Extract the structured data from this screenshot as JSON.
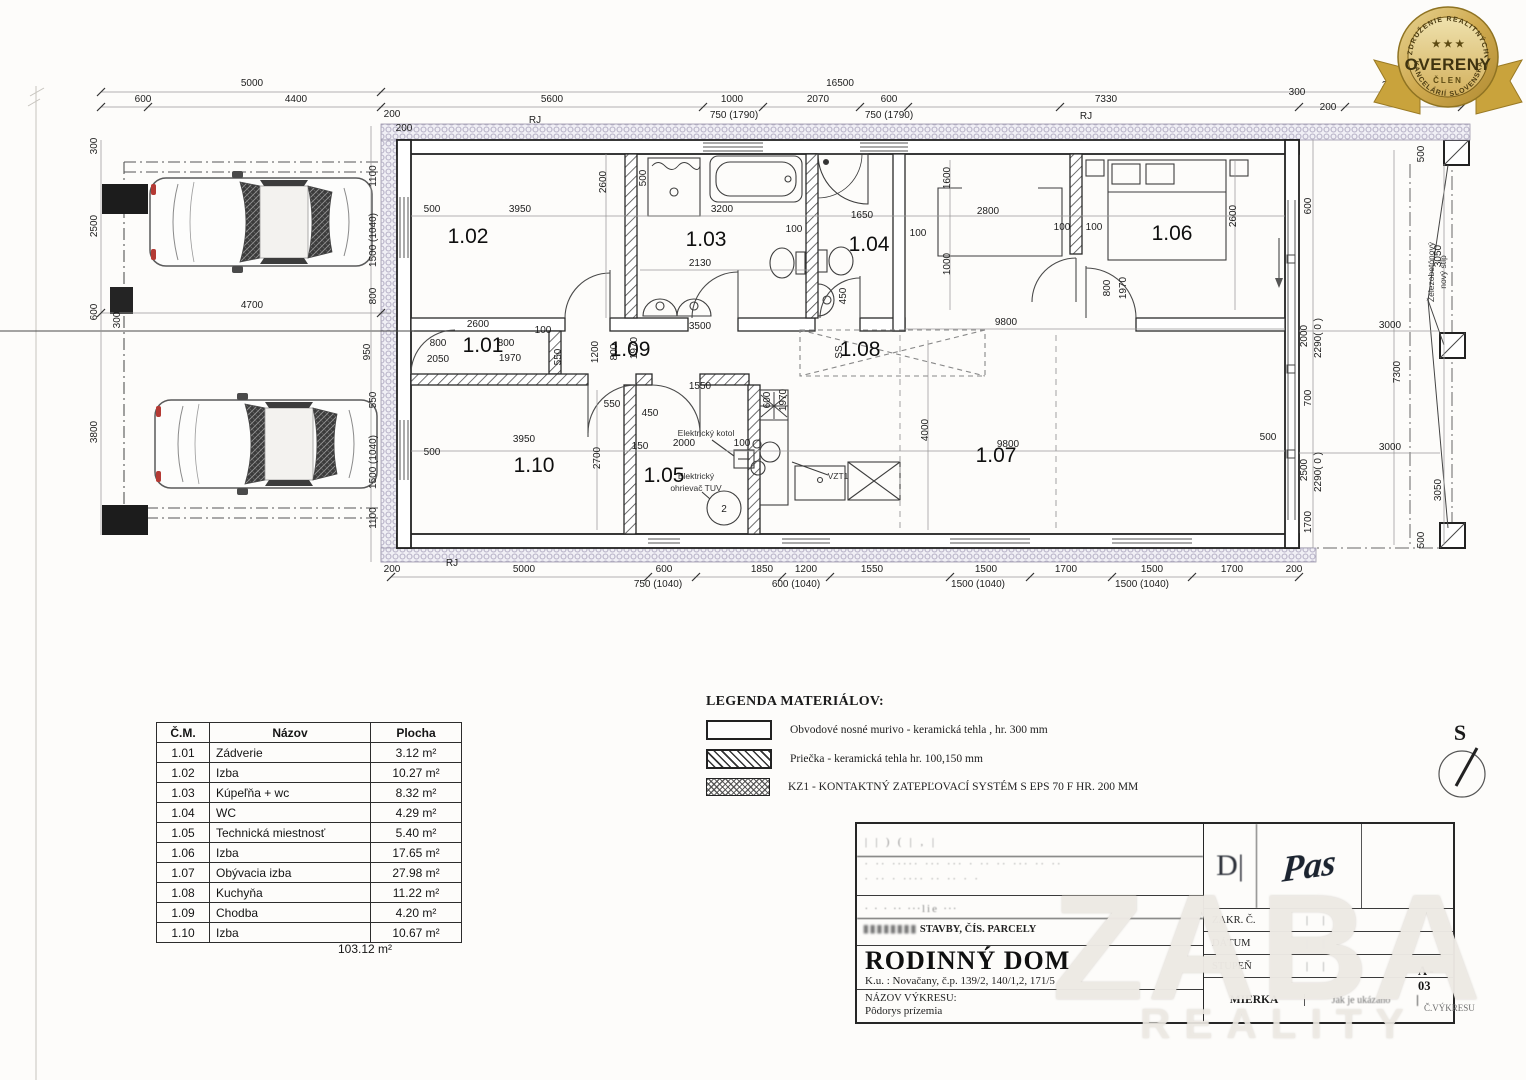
{
  "badge": {
    "arc_top": "ZDRUŽENIE REALITNÝCH",
    "arc_bottom": "KANCELÁRIÍ SLOVENSKA",
    "stars": "★ ★ ★",
    "title": "OVERENÝ",
    "subtitle": "ČLEN",
    "gold": "#c9a84c"
  },
  "north": {
    "label": "S"
  },
  "watermark": {
    "main": "ZABA",
    "sub": "REALITY"
  },
  "plan": {
    "rooms": [
      {
        "id": "1.01",
        "x": 483,
        "y": 352
      },
      {
        "id": "1.02",
        "x": 468,
        "y": 243
      },
      {
        "id": "1.03",
        "x": 706,
        "y": 246
      },
      {
        "id": "1.04",
        "x": 869,
        "y": 251
      },
      {
        "id": "1.05",
        "x": 664,
        "y": 482
      },
      {
        "id": "1.06",
        "x": 1172,
        "y": 240
      },
      {
        "id": "1.07",
        "x": 996,
        "y": 462
      },
      {
        "id": "1.08",
        "x": 860,
        "y": 356
      },
      {
        "id": "1.09",
        "x": 630,
        "y": 356
      },
      {
        "id": "1.10",
        "x": 534,
        "y": 472
      }
    ],
    "dims": [
      {
        "t": "5000",
        "x": 252,
        "y": 86
      },
      {
        "t": "600",
        "x": 143,
        "y": 102
      },
      {
        "t": "4400",
        "x": 296,
        "y": 102
      },
      {
        "t": "16500",
        "x": 840,
        "y": 86
      },
      {
        "t": "5600",
        "x": 552,
        "y": 102
      },
      {
        "t": "1000",
        "x": 732,
        "y": 102
      },
      {
        "t": "750 (1790)",
        "x": 734,
        "y": 118
      },
      {
        "t": "2070",
        "x": 818,
        "y": 102
      },
      {
        "t": "600",
        "x": 889,
        "y": 102
      },
      {
        "t": "750 (1790)",
        "x": 889,
        "y": 118
      },
      {
        "t": "7330",
        "x": 1106,
        "y": 102
      },
      {
        "t": "300",
        "x": 1297,
        "y": 95
      },
      {
        "t": "3500",
        "x": 1393,
        "y": 88
      },
      {
        "t": "3000",
        "x": 1391,
        "y": 104
      },
      {
        "t": "200",
        "x": 1328,
        "y": 110
      },
      {
        "t": "RJ",
        "x": 535,
        "y": 123
      },
      {
        "t": "RJ",
        "x": 1086,
        "y": 119
      },
      {
        "t": "200",
        "x": 392,
        "y": 117
      },
      {
        "t": "200",
        "x": 404,
        "y": 131
      },
      {
        "t": "300",
        "x": 97,
        "y": 146,
        "r": -90
      },
      {
        "t": "2500",
        "x": 97,
        "y": 226,
        "r": -90
      },
      {
        "t": "600",
        "x": 97,
        "y": 312,
        "r": -90
      },
      {
        "t": "3800",
        "x": 97,
        "y": 432,
        "r": -90
      },
      {
        "t": "300",
        "x": 120,
        "y": 320,
        "r": -90
      },
      {
        "t": "4700",
        "x": 252,
        "y": 308
      },
      {
        "t": "1100",
        "x": 376,
        "y": 176,
        "r": -90
      },
      {
        "t": "1500 (1040)",
        "x": 376,
        "y": 240,
        "r": -90
      },
      {
        "t": "800",
        "x": 376,
        "y": 296,
        "r": -90
      },
      {
        "t": "950",
        "x": 370,
        "y": 352,
        "r": -90
      },
      {
        "t": "550",
        "x": 376,
        "y": 400,
        "r": -90
      },
      {
        "t": "1500 (1040)",
        "x": 376,
        "y": 462,
        "r": -90
      },
      {
        "t": "1100",
        "x": 376,
        "y": 518,
        "r": -90
      },
      {
        "t": "500",
        "x": 432,
        "y": 212
      },
      {
        "t": "3950",
        "x": 520,
        "y": 212
      },
      {
        "t": "2600",
        "x": 606,
        "y": 182,
        "r": -90
      },
      {
        "t": "500",
        "x": 646,
        "y": 178,
        "r": -90
      },
      {
        "t": "3200",
        "x": 722,
        "y": 212
      },
      {
        "t": "2130",
        "x": 700,
        "y": 266
      },
      {
        "t": "100",
        "x": 794,
        "y": 232
      },
      {
        "t": "1650",
        "x": 862,
        "y": 218
      },
      {
        "t": "450",
        "x": 846,
        "y": 296,
        "r": -90
      },
      {
        "t": "1600",
        "x": 950,
        "y": 178,
        "r": -90
      },
      {
        "t": "2800",
        "x": 988,
        "y": 214
      },
      {
        "t": "100",
        "x": 918,
        "y": 236
      },
      {
        "t": "100",
        "x": 1062,
        "y": 230
      },
      {
        "t": "1000",
        "x": 950,
        "y": 264,
        "r": -90
      },
      {
        "t": "2600",
        "x": 1236,
        "y": 216,
        "r": -90
      },
      {
        "t": "100",
        "x": 1094,
        "y": 230
      },
      {
        "t": "800",
        "x": 1110,
        "y": 288,
        "r": -90
      },
      {
        "t": "1970",
        "x": 1126,
        "y": 288,
        "r": -90
      },
      {
        "t": "2600",
        "x": 478,
        "y": 327
      },
      {
        "t": "100",
        "x": 543,
        "y": 333
      },
      {
        "t": "3500",
        "x": 700,
        "y": 329
      },
      {
        "t": "9800",
        "x": 1006,
        "y": 325
      },
      {
        "t": "1200",
        "x": 598,
        "y": 352,
        "r": -90
      },
      {
        "t": "800",
        "x": 617,
        "y": 352,
        "r": -90
      },
      {
        "t": "1970",
        "x": 637,
        "y": 348,
        "r": -90
      },
      {
        "t": "SS",
        "x": 842,
        "y": 352,
        "r": -90
      },
      {
        "t": "800",
        "x": 438,
        "y": 346
      },
      {
        "t": "2050",
        "x": 438,
        "y": 362
      },
      {
        "t": "800",
        "x": 506,
        "y": 346
      },
      {
        "t": "1970",
        "x": 510,
        "y": 361
      },
      {
        "t": "550",
        "x": 561,
        "y": 357,
        "r": -90
      },
      {
        "t": "1550",
        "x": 700,
        "y": 389
      },
      {
        "t": "600",
        "x": 770,
        "y": 400,
        "r": -90
      },
      {
        "t": "1970",
        "x": 786,
        "y": 400,
        "r": -90
      },
      {
        "t": "550",
        "x": 612,
        "y": 407
      },
      {
        "t": "450",
        "x": 650,
        "y": 416
      },
      {
        "t": "150",
        "x": 640,
        "y": 449
      },
      {
        "t": "2000",
        "x": 684,
        "y": 446
      },
      {
        "t": "100",
        "x": 742,
        "y": 446
      },
      {
        "t": "Elektrický kotol",
        "x": 706,
        "y": 436,
        "s": 1
      },
      {
        "t": "Elektrický",
        "x": 696,
        "y": 479,
        "s": 1
      },
      {
        "t": "ohrievač TUV",
        "x": 696,
        "y": 491,
        "s": 1
      },
      {
        "t": "VZT1",
        "x": 838,
        "y": 479,
        "s": 1
      },
      {
        "t": "500",
        "x": 432,
        "y": 455
      },
      {
        "t": "3950",
        "x": 524,
        "y": 442
      },
      {
        "t": "2700",
        "x": 600,
        "y": 458,
        "r": -90
      },
      {
        "t": "9800",
        "x": 1008,
        "y": 447
      },
      {
        "t": "4000",
        "x": 928,
        "y": 430,
        "r": -90
      },
      {
        "t": "500",
        "x": 1268,
        "y": 440
      },
      {
        "t": "600",
        "x": 1311,
        "y": 206,
        "r": -90
      },
      {
        "t": "2000",
        "x": 1307,
        "y": 336,
        "r": -90
      },
      {
        "t": "2290( 0 )",
        "x": 1321,
        "y": 338,
        "r": -90
      },
      {
        "t": "700",
        "x": 1311,
        "y": 398,
        "r": -90
      },
      {
        "t": "2500",
        "x": 1307,
        "y": 470,
        "r": -90
      },
      {
        "t": "2290( 0 )",
        "x": 1321,
        "y": 472,
        "r": -90
      },
      {
        "t": "1700",
        "x": 1311,
        "y": 522,
        "r": -90
      },
      {
        "t": "3000",
        "x": 1390,
        "y": 328
      },
      {
        "t": "3000",
        "x": 1390,
        "y": 450
      },
      {
        "t": "7300",
        "x": 1400,
        "y": 372,
        "r": -90
      },
      {
        "t": "3050",
        "x": 1441,
        "y": 256,
        "r": -90
      },
      {
        "t": "3050",
        "x": 1441,
        "y": 490,
        "r": -90
      },
      {
        "t": "500",
        "x": 1424,
        "y": 154,
        "r": -90
      },
      {
        "t": "500",
        "x": 1424,
        "y": 540,
        "r": -90
      },
      {
        "t": "Železobetónový",
        "x": 1434,
        "y": 272,
        "r": -90,
        "s": 1
      },
      {
        "t": "nový stĺp",
        "x": 1446,
        "y": 272,
        "r": -90,
        "s": 1
      },
      {
        "t": "200",
        "x": 392,
        "y": 572
      },
      {
        "t": "RJ",
        "x": 452,
        "y": 566
      },
      {
        "t": "5000",
        "x": 524,
        "y": 572
      },
      {
        "t": "600",
        "x": 664,
        "y": 572
      },
      {
        "t": "750 (1040)",
        "x": 658,
        "y": 587
      },
      {
        "t": "1850",
        "x": 762,
        "y": 572
      },
      {
        "t": "1200",
        "x": 806,
        "y": 572
      },
      {
        "t": "600 (1040)",
        "x": 796,
        "y": 587
      },
      {
        "t": "1550",
        "x": 872,
        "y": 572
      },
      {
        "t": "1500",
        "x": 986,
        "y": 572
      },
      {
        "t": "1500 (1040)",
        "x": 978,
        "y": 587
      },
      {
        "t": "1700",
        "x": 1066,
        "y": 572
      },
      {
        "t": "1500",
        "x": 1152,
        "y": 572
      },
      {
        "t": "1500 (1040)",
        "x": 1142,
        "y": 587
      },
      {
        "t": "1700",
        "x": 1232,
        "y": 572
      },
      {
        "t": "200",
        "x": 1294,
        "y": 572
      }
    ]
  },
  "room_table": {
    "headers": [
      "Č.M.",
      "Názov",
      "Plocha"
    ],
    "rows": [
      [
        "1.01",
        "Zádverie",
        "3.12 m²"
      ],
      [
        "1.02",
        "Izba",
        "10.27 m²"
      ],
      [
        "1.03",
        "Kúpeľňa + wc",
        "8.32 m²"
      ],
      [
        "1.04",
        "WC",
        "4.29 m²"
      ],
      [
        "1.05",
        "Technická miestnosť",
        "5.40 m²"
      ],
      [
        "1.06",
        "Izba",
        "17.65 m²"
      ],
      [
        "1.07",
        "Obývacia izba",
        "27.98 m²"
      ],
      [
        "1.08",
        "Kuchyňa",
        "11.22 m²"
      ],
      [
        "1.09",
        "Chodba",
        "4.20 m²"
      ],
      [
        "1.10",
        "Izba",
        "10.67 m²"
      ]
    ],
    "total": "103.12 m²"
  },
  "material_legend": {
    "title": "LEGENDA MATERIÁLOV:",
    "items": [
      {
        "name": "bearing-wall",
        "label": "Obvodové nosné murivo - keramická tehla  , hr. 300 mm"
      },
      {
        "name": "partition",
        "label": "Priečka - keramická tehla hr. 100,150 mm"
      },
      {
        "name": "insulation",
        "label": "KZ1 - KONTAKTNÝ ZATEPĽOVACÍ SYSTÉM S EPS 70 F HR. 200 MM"
      }
    ]
  },
  "title_block": {
    "smudge1": "|  |   )  (  |  ‚  |",
    "smudge2a": "∙ ∙∙ ∙∙∙∙∙ ∙∙∙ ∙∙∙ ∙ ∙∙ ∙∙  ∙∙∙  ∙∙  ∙∙",
    "smudge2b": "∙ ∙∙ ∙ ∙∙∙∙ ∙∙ ∙∙ ∙ ∙",
    "smudge3": "∙   ∙   ∙  ∙∙ ∙∙∙lie   ∙∙∙",
    "parcel_pre": "▮▮▮▮▮▮▮▮",
    "parcel_text": " STAVBY, ČÍS. PARCELY",
    "project_title": "RODINNÝ DOM",
    "location": "K.u. : Novačany, č.p. 139/2, 140/1,2, 171/5",
    "drawing_label": "NÁZOV VÝKRESU:",
    "drawing_name": "Pôdorys prízemia",
    "sig_mark": "D|",
    "signature": "Pas",
    "fields": {
      "zakr": "ZAKR. Č.",
      "datum": "DÁTUM",
      "stupen": "STUPEŇ",
      "tick": "| |",
      "mierka": "MIERKA",
      "scale_value": "Jak je ukázáno",
      "cislo_label": "Č.VÝKRESU",
      "cislo_value": "A - 03"
    }
  }
}
